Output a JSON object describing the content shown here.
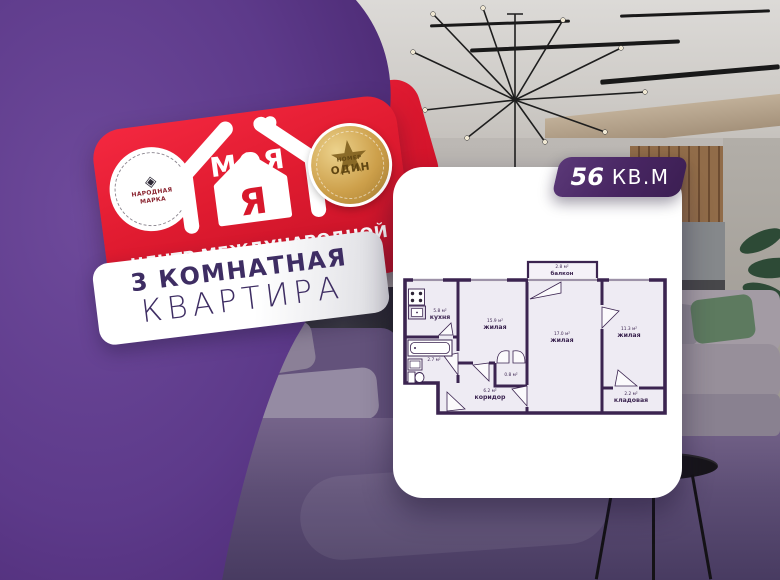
{
  "brand": {
    "logo_word_top": "МОЯ",
    "logo_letter": "Я",
    "tagline_line1": "ЦЕНТР МЕЖДУНАРОДНОЙ",
    "tagline_line2": "НЕДВИЖИМОСТИ",
    "left_medal": {
      "diamond_glyph": "◈",
      "line1": "НАРОДНАЯ",
      "line2": "МАРКА"
    },
    "right_medal": {
      "star_glyph": "★",
      "line1": "НОМЕР",
      "line2": "ОДИН"
    }
  },
  "banner": {
    "line1": "3 КОМНАТНАЯ",
    "line2": "КВАРТИРА"
  },
  "area_badge": {
    "value": "56",
    "unit": "КВ.М"
  },
  "floorplan": {
    "rooms": [
      {
        "name": "кухня",
        "area": "5.8 м²"
      },
      {
        "name": "жилая",
        "area": "15.9 м²"
      },
      {
        "name": "жилая",
        "area": "17.0 м²"
      },
      {
        "name": "жилая",
        "area": "11.3 м²"
      },
      {
        "name": "коридор",
        "area": "6.2 м²"
      },
      {
        "name": "кладовая",
        "area": "2.2 м²"
      },
      {
        "name": "балкон",
        "area": "2.8 м²"
      },
      {
        "name": "",
        "area": "2.7 м²"
      },
      {
        "name": "",
        "area": "0.8 м²"
      }
    ]
  },
  "colors": {
    "purple_blob": "#5d3a8a",
    "brand_red": "#e01b30",
    "badge_purple": "#472561",
    "plan_wall": "#3b2450"
  }
}
